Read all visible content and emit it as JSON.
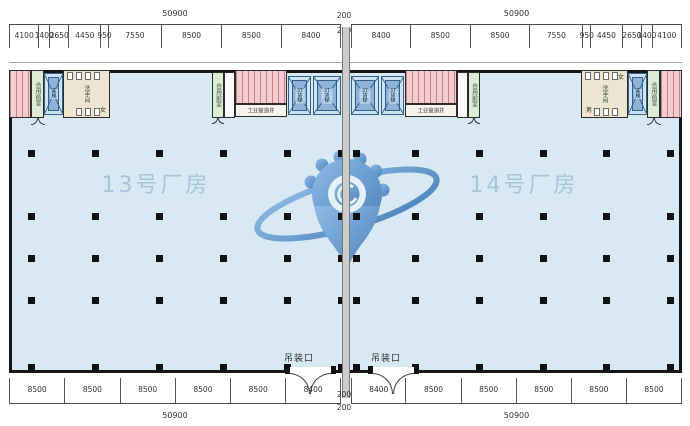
{
  "buildings": {
    "left_label": "13号厂房",
    "right_label": "14号厂房"
  },
  "dims": {
    "top_total_left": "50900",
    "top_total_right": "50900",
    "top_gap_upper": "200",
    "top_gap_lower": "200",
    "top_segments_left": [
      "4100",
      "1400",
      "2650",
      "4450",
      "950",
      "7550",
      "8500",
      "8500",
      "8400"
    ],
    "top_segments_right": [
      "8400",
      "8500",
      "8500",
      "7550",
      "950",
      "4450",
      "2650",
      "1400",
      "4100"
    ],
    "bottom_segments_left": [
      "8500",
      "8500",
      "8500",
      "8500",
      "8500",
      "8400"
    ],
    "bottom_segments_right": [
      "8400",
      "8500",
      "8500",
      "8500",
      "8500",
      "8500"
    ],
    "bottom_gap_upper": "200",
    "bottom_gap_lower": "200",
    "bottom_total_left": "50900",
    "bottom_total_right": "50900"
  },
  "annotations": {
    "hoist_opening_left": "吊装口",
    "hoist_opening_right": "吊装口"
  },
  "rooms": {
    "washroom": "洗手间",
    "male": "男",
    "female": "女",
    "shared_lobby": "合用前室",
    "freight_elevator": "3T货梯",
    "passenger_elevator": "客梯",
    "pipe_shaft": "工业管道井"
  },
  "colors": {
    "floor": "#d9e9f4",
    "room_pink": "#f5cdd1",
    "room_green": "#dcecd5",
    "room_beige": "#ede4d1",
    "elevator_fill": "#cfe3f2",
    "elevator_line": "#2f5f8f",
    "label_blue": "#a6c4da",
    "watermark_blue": "#3e7cc0",
    "wall": "#161616",
    "dim_text": "#333333"
  }
}
